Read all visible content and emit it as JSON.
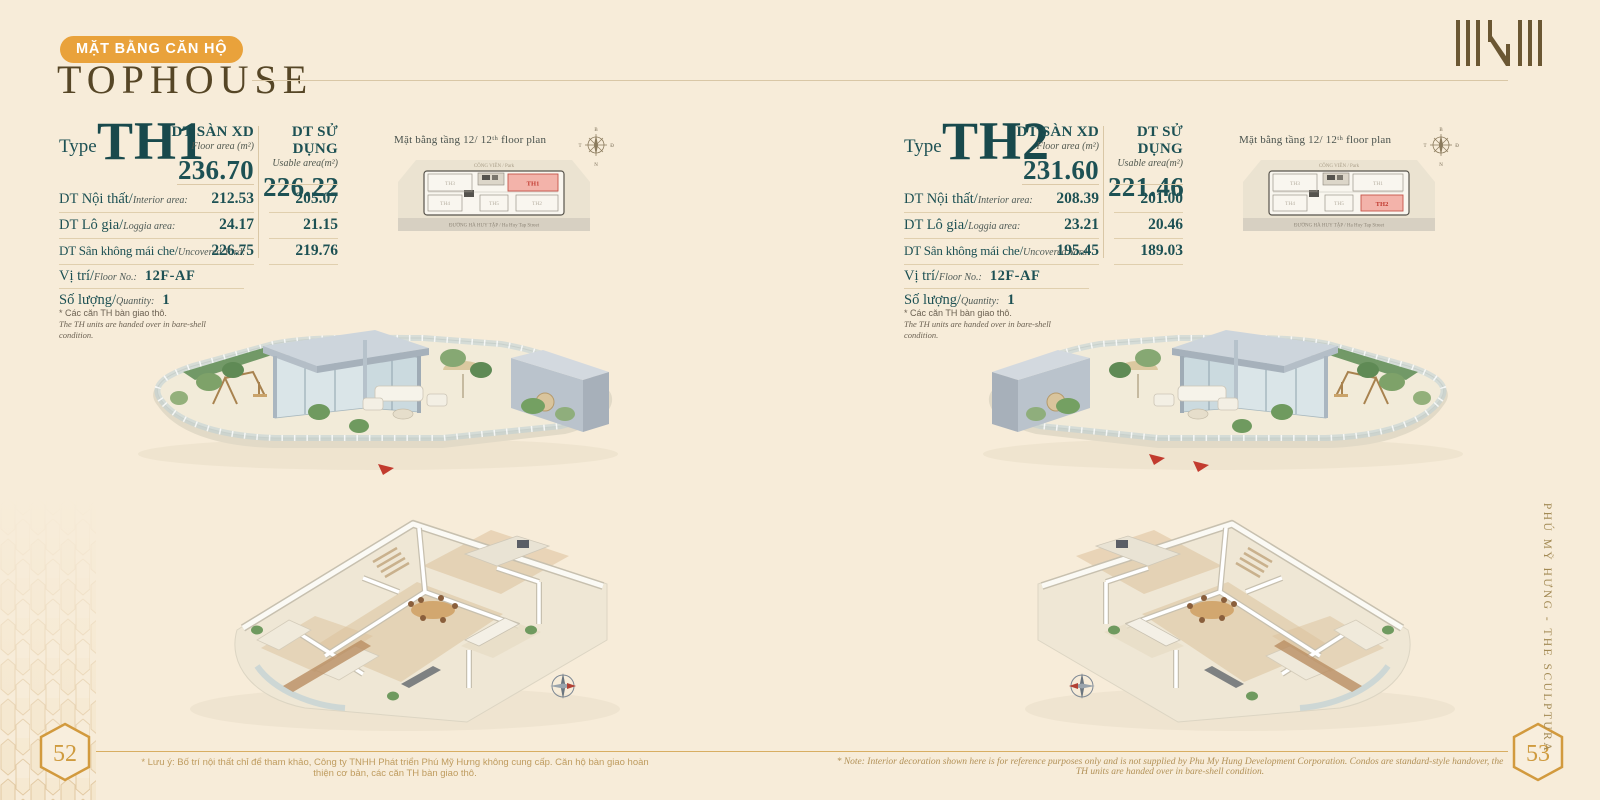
{
  "page": {
    "badge": "MẶT BẰNG CĂN HỘ",
    "title": "TOPHOUSE",
    "side_text": "PHÚ MỸ HƯNG - THE SCULPTURA",
    "left_page_number": "52",
    "right_page_number": "53",
    "footer_note_vi": "* Lưu ý: Bố trí nội thất chỉ để tham khảo, Công ty TNHH Phát triển Phú Mỹ Hưng không cung cấp. Căn hộ bàn giao hoàn thiện cơ bản, các căn TH bàn giao thô.",
    "footer_note_en": "* Note: Interior decoration shown here is for reference purposes only and is not supplied by Phu My Hung Development Corporation. Condos are standard-style handover, the TH units are handed over in bare-shell condition."
  },
  "compass": {
    "north": "B",
    "east": "Đ",
    "south": "N",
    "west": "T"
  },
  "colors": {
    "accent_orange": "#E9A23B",
    "teal": "#1D5154",
    "gold": "#CF9B3F",
    "highlight_pink": "#F3B3AA",
    "highlight_red": "#C0392F",
    "background": "#F7ECD9"
  },
  "units": [
    {
      "type_label": "Type",
      "type_code": "TH1",
      "floor_area": {
        "title": "DT SÀN XD",
        "subtitle": "Floor area (m²)",
        "value": "236.70"
      },
      "usable_area": {
        "title": "DT SỬ DỤNG",
        "subtitle": "Usable area(m²)",
        "value": "226.22"
      },
      "rows": [
        {
          "label_vi": "DT Nội thất/",
          "label_en": "Interior area:",
          "floor": "212.53",
          "usable": "205.07"
        },
        {
          "label_vi": "DT Lô gia/",
          "label_en": "Loggia area:",
          "floor": "24.17",
          "usable": "21.15"
        },
        {
          "label_vi": "DT Sân không mái che/",
          "label_en": "Uncovered Yard:",
          "floor": "226.75",
          "usable": "219.76"
        }
      ],
      "location": {
        "label_vi": "Vị trí/",
        "label_en": "Floor No.:",
        "value": "12F-AF"
      },
      "quantity": {
        "label_vi": "Số lượng/",
        "label_en": "Quantity:",
        "value": "1"
      },
      "note_vi": "* Các căn TH bàn giao thô.",
      "note_en": "The TH units are handed over in bare-shell condition.",
      "miniplan": {
        "title": "Mặt bằng tầng 12/ 12ᵗʰ floor plan",
        "park_label": "CÔNG VIÊN / Park",
        "street_label": "ĐƯỜNG HÀ HUY TẬP / Ha Huy Tap Street",
        "unit_top_left": "TH3",
        "unit_top_right": "TH1",
        "unit_bottom_left": "TH4",
        "unit_bottom_mid": "TH5",
        "unit_bottom_right": "TH2",
        "highlighted": "TH1"
      }
    },
    {
      "type_label": "Type",
      "type_code": "TH2",
      "floor_area": {
        "title": "DT SÀN XD",
        "subtitle": "Floor area (m²)",
        "value": "231.60"
      },
      "usable_area": {
        "title": "DT SỬ DỤNG",
        "subtitle": "Usable area(m²)",
        "value": "221.46"
      },
      "rows": [
        {
          "label_vi": "DT Nội thất/",
          "label_en": "Interior area:",
          "floor": "208.39",
          "usable": "201.00"
        },
        {
          "label_vi": "DT Lô gia/",
          "label_en": "Loggia area:",
          "floor": "23.21",
          "usable": "20.46"
        },
        {
          "label_vi": "DT Sân không mái che/",
          "label_en": "Uncovered Yard:",
          "floor": "195.45",
          "usable": "189.03"
        }
      ],
      "location": {
        "label_vi": "Vị trí/",
        "label_en": "Floor No.:",
        "value": "12F-AF"
      },
      "quantity": {
        "label_vi": "Số lượng/",
        "label_en": "Quantity:",
        "value": "1"
      },
      "note_vi": "* Các căn TH bàn giao thô.",
      "note_en": "The TH units are handed over in bare-shell condition.",
      "miniplan": {
        "title": "Mặt bằng tầng 12/ 12ᵗʰ floor plan",
        "park_label": "CÔNG VIÊN / Park",
        "street_label": "ĐƯỜNG HÀ HUY TẬP / Ha Huy Tap Street",
        "unit_top_left": "TH3",
        "unit_top_right": "TH1",
        "unit_bottom_left": "TH4",
        "unit_bottom_mid": "TH5",
        "unit_bottom_right": "TH2",
        "highlighted": "TH2"
      }
    }
  ]
}
